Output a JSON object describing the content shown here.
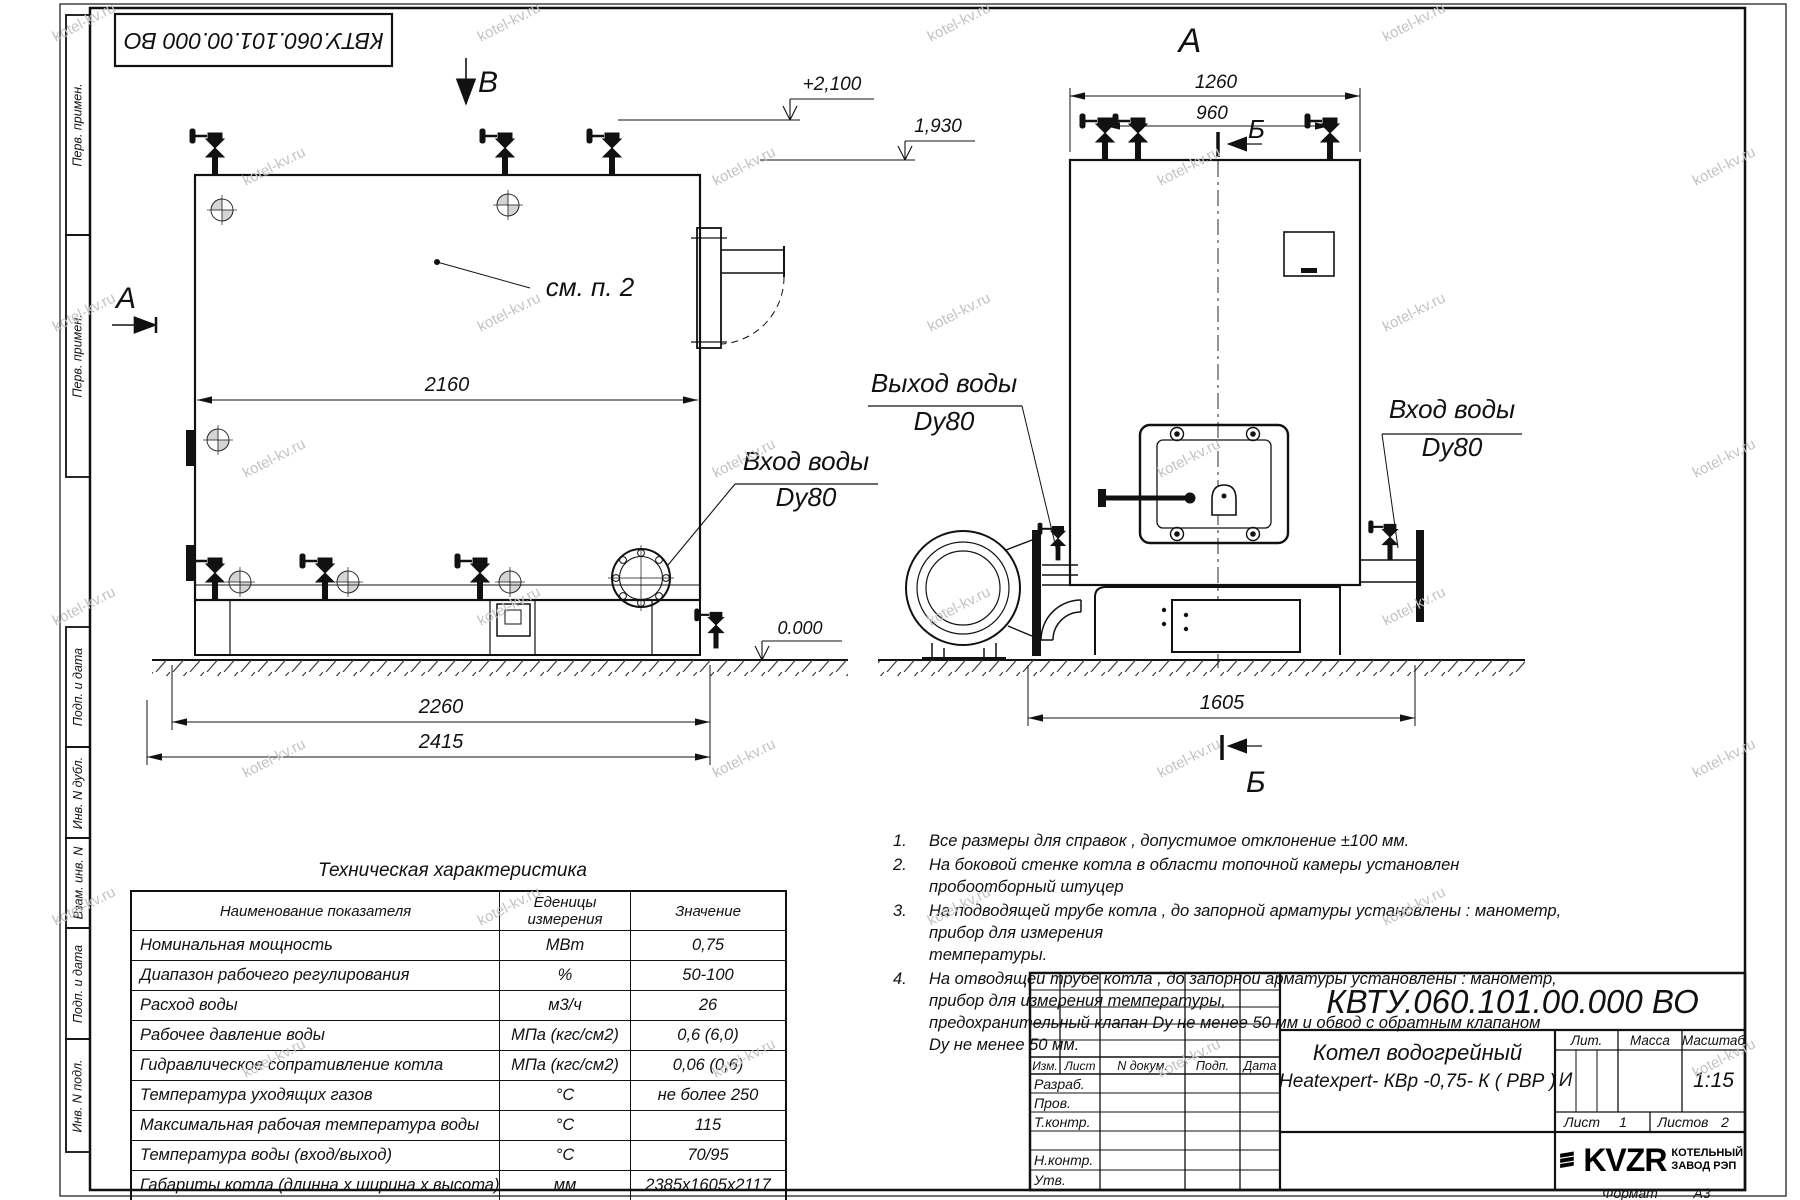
{
  "watermark": "kotel-kv.ru",
  "stamp_top": "КВТУ.060.101.00.000  ВО",
  "margin": {
    "labels": [
      "Перв. примен.",
      "Перв. примен.",
      "Подп. и дата",
      "Инв. N дубл.",
      "Взам. инв. N",
      "Подп. и дата",
      "Инв. N подл."
    ]
  },
  "left_view": {
    "section_b": "В",
    "section_a": "А",
    "level_top": "+2,100",
    "level_mid": "1,930",
    "level_zero": "0.000",
    "see_note": "см. п. 2",
    "dim_width": "2160",
    "dim_frame": "2260",
    "dim_overall": "2415",
    "inlet_line1": "Вход воды",
    "inlet_line2": "Dy80"
  },
  "right_view": {
    "view_a": "А",
    "section_b_top": "Б",
    "section_b_bottom": "Б",
    "dim_width": "1260",
    "dim_valves": "960",
    "dim_depth": "1605",
    "outlet_line1": "Выход воды",
    "outlet_line2": "Dy80",
    "inlet_line1": "Вход воды",
    "inlet_line2": "Dy80"
  },
  "notes": {
    "items": [
      {
        "num": "1.",
        "l1": "Все размеры для справок , допустимое отклонение  ±100 мм.",
        "l2": ""
      },
      {
        "num": "2.",
        "l1": "На боковой стенке котла в области топочной камеры установлен пробоотборный штуцер",
        "l2": ""
      },
      {
        "num": "3.",
        "l1": "На   подводящей трубе котла , до запорной арматуры установлены :  манометр,  прибор для измерения",
        "l2": "температуры."
      },
      {
        "num": "4.",
        "l1": "На отводящей трубе котла , до запорной арматуры установлены :  манометр,  прибор для измерения температуры,",
        "l2": "предохранительный клапан  Dу не менее  50 мм и обвод с обратным клапаном  Dу не менее  50 мм."
      }
    ]
  },
  "tech_table": {
    "title": "Техническая характеристика",
    "headers": [
      "Наименование показателя",
      "Еденицы измерения",
      "Значение"
    ],
    "rows": [
      [
        "Номинальная мощность",
        "МВт",
        "0,75"
      ],
      [
        "Диапазон рабочего регулирования",
        "%",
        "50-100"
      ],
      [
        "Расход воды",
        "м3/ч",
        "26"
      ],
      [
        "Рабочее давление воды",
        "МПа (кгс/см2)",
        "0,6 (6,0)"
      ],
      [
        "Гидравлическое сопративление котла",
        "МПа (кгс/см2)",
        "0,06 (0,6)"
      ],
      [
        "Температура уходящих газов",
        "°С",
        "не более 250"
      ],
      [
        "Максимальная рабочая температура воды",
        "°С",
        "115"
      ],
      [
        "Температура воды (вход/выход)",
        "°С",
        "70/95"
      ],
      [
        "Габариты котла (длинна х ширина х высота)",
        "мм",
        "2385х1605х2117"
      ]
    ]
  },
  "title_block": {
    "designation": "КВТУ.060.101.00.000  ВО",
    "product_line1": "Котел водогрейный",
    "product_line2": "Heatexpert- КВр -0,75- К ( РВР )",
    "col_izm": "Изм.",
    "col_list": "Лист",
    "col_doc": "N докум.",
    "col_sign": "Подп.",
    "col_date": "Дата",
    "row_razrab": "Разраб.",
    "row_prov": "Пров.",
    "row_tkontr": "Т.контр.",
    "row_nkontr": "Н.контр.",
    "row_utv": "Утв.",
    "lit_label": "Лит.",
    "mass_label": "Масса",
    "scale_label": "Масштаб",
    "lit_value": "И",
    "scale_value": "1:15",
    "sheet_label": "Лист",
    "sheet_value": "1",
    "sheets_label": "Листов",
    "sheets_value": "2",
    "logo_text": "KVZR",
    "logo_cap1": "КОТЕЛЬНЫЙ",
    "logo_cap2": "ЗАВОД РЭП",
    "format_label": "Формат",
    "format_value": "А3"
  }
}
